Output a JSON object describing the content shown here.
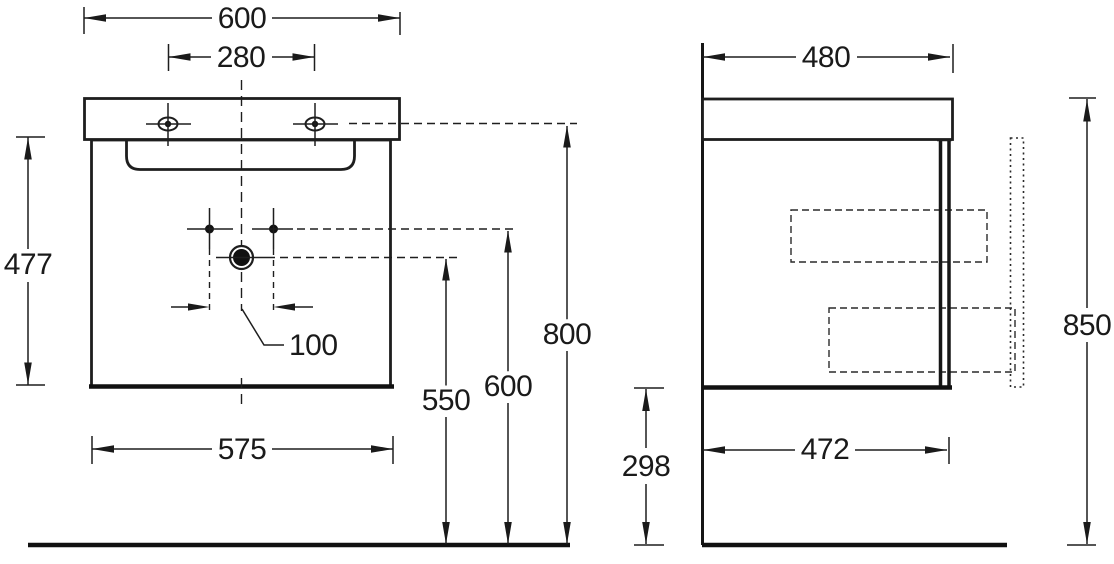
{
  "colors": {
    "line": "#1e1e1e",
    "background": "#ffffff",
    "text": "#1a1a1a"
  },
  "front_view": {
    "top_width": "600",
    "faucet_spacing": "280",
    "side_height": "477",
    "drain_offset": "100",
    "bottom_width": "575",
    "drain_height": "550",
    "fixing_height": "600",
    "rim_height": "800"
  },
  "side_view": {
    "top_depth": "480",
    "under_clearance": "298",
    "bottom_depth": "472",
    "overall_height": "850"
  }
}
